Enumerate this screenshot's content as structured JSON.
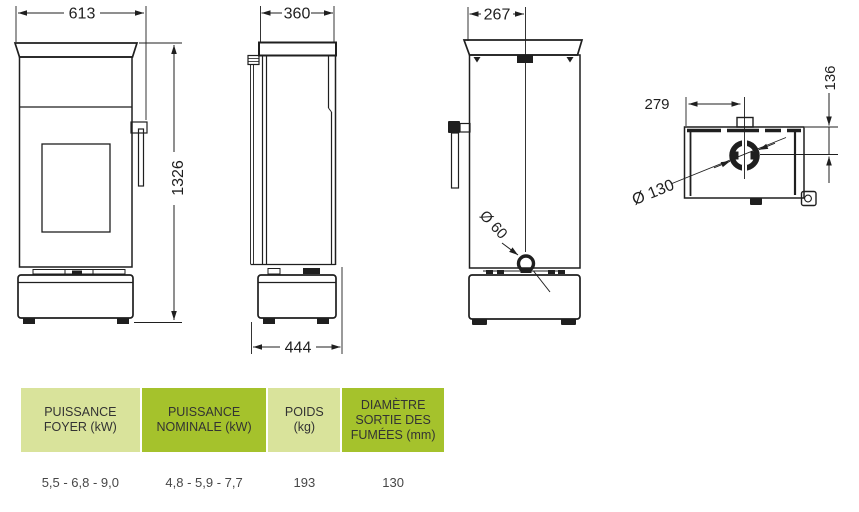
{
  "colors": {
    "line": "#1f1f1f",
    "table_light_green": "#d9e39b",
    "table_dark_green": "#a5c22c",
    "header_text": "#333333",
    "value_text": "#474747"
  },
  "drawing": {
    "front_view": {
      "width": "613",
      "height": "1326"
    },
    "side_view": {
      "top_width": "360",
      "base_depth": "444"
    },
    "rear_view": {
      "offset": "267",
      "air_inlet_diameter": "Ø 60"
    },
    "top_view": {
      "flue_offset": "279",
      "flue_depth": "136",
      "flue_diameter": "Ø 130"
    }
  },
  "table": {
    "columns": [
      {
        "header": "PUISSANCE\nFOYER (kW)",
        "value": "5,5 - 6,8 - 9,0"
      },
      {
        "header": "PUISSANCE\nNOMINALE (kW)",
        "value": "4,8 - 5,9 - 7,7"
      },
      {
        "header": "POIDS\n(kg)",
        "value": "193"
      },
      {
        "header": "DIAMÈTRE\nSORTIE DES\nFUMÉES (mm)",
        "value": "130"
      }
    ]
  }
}
